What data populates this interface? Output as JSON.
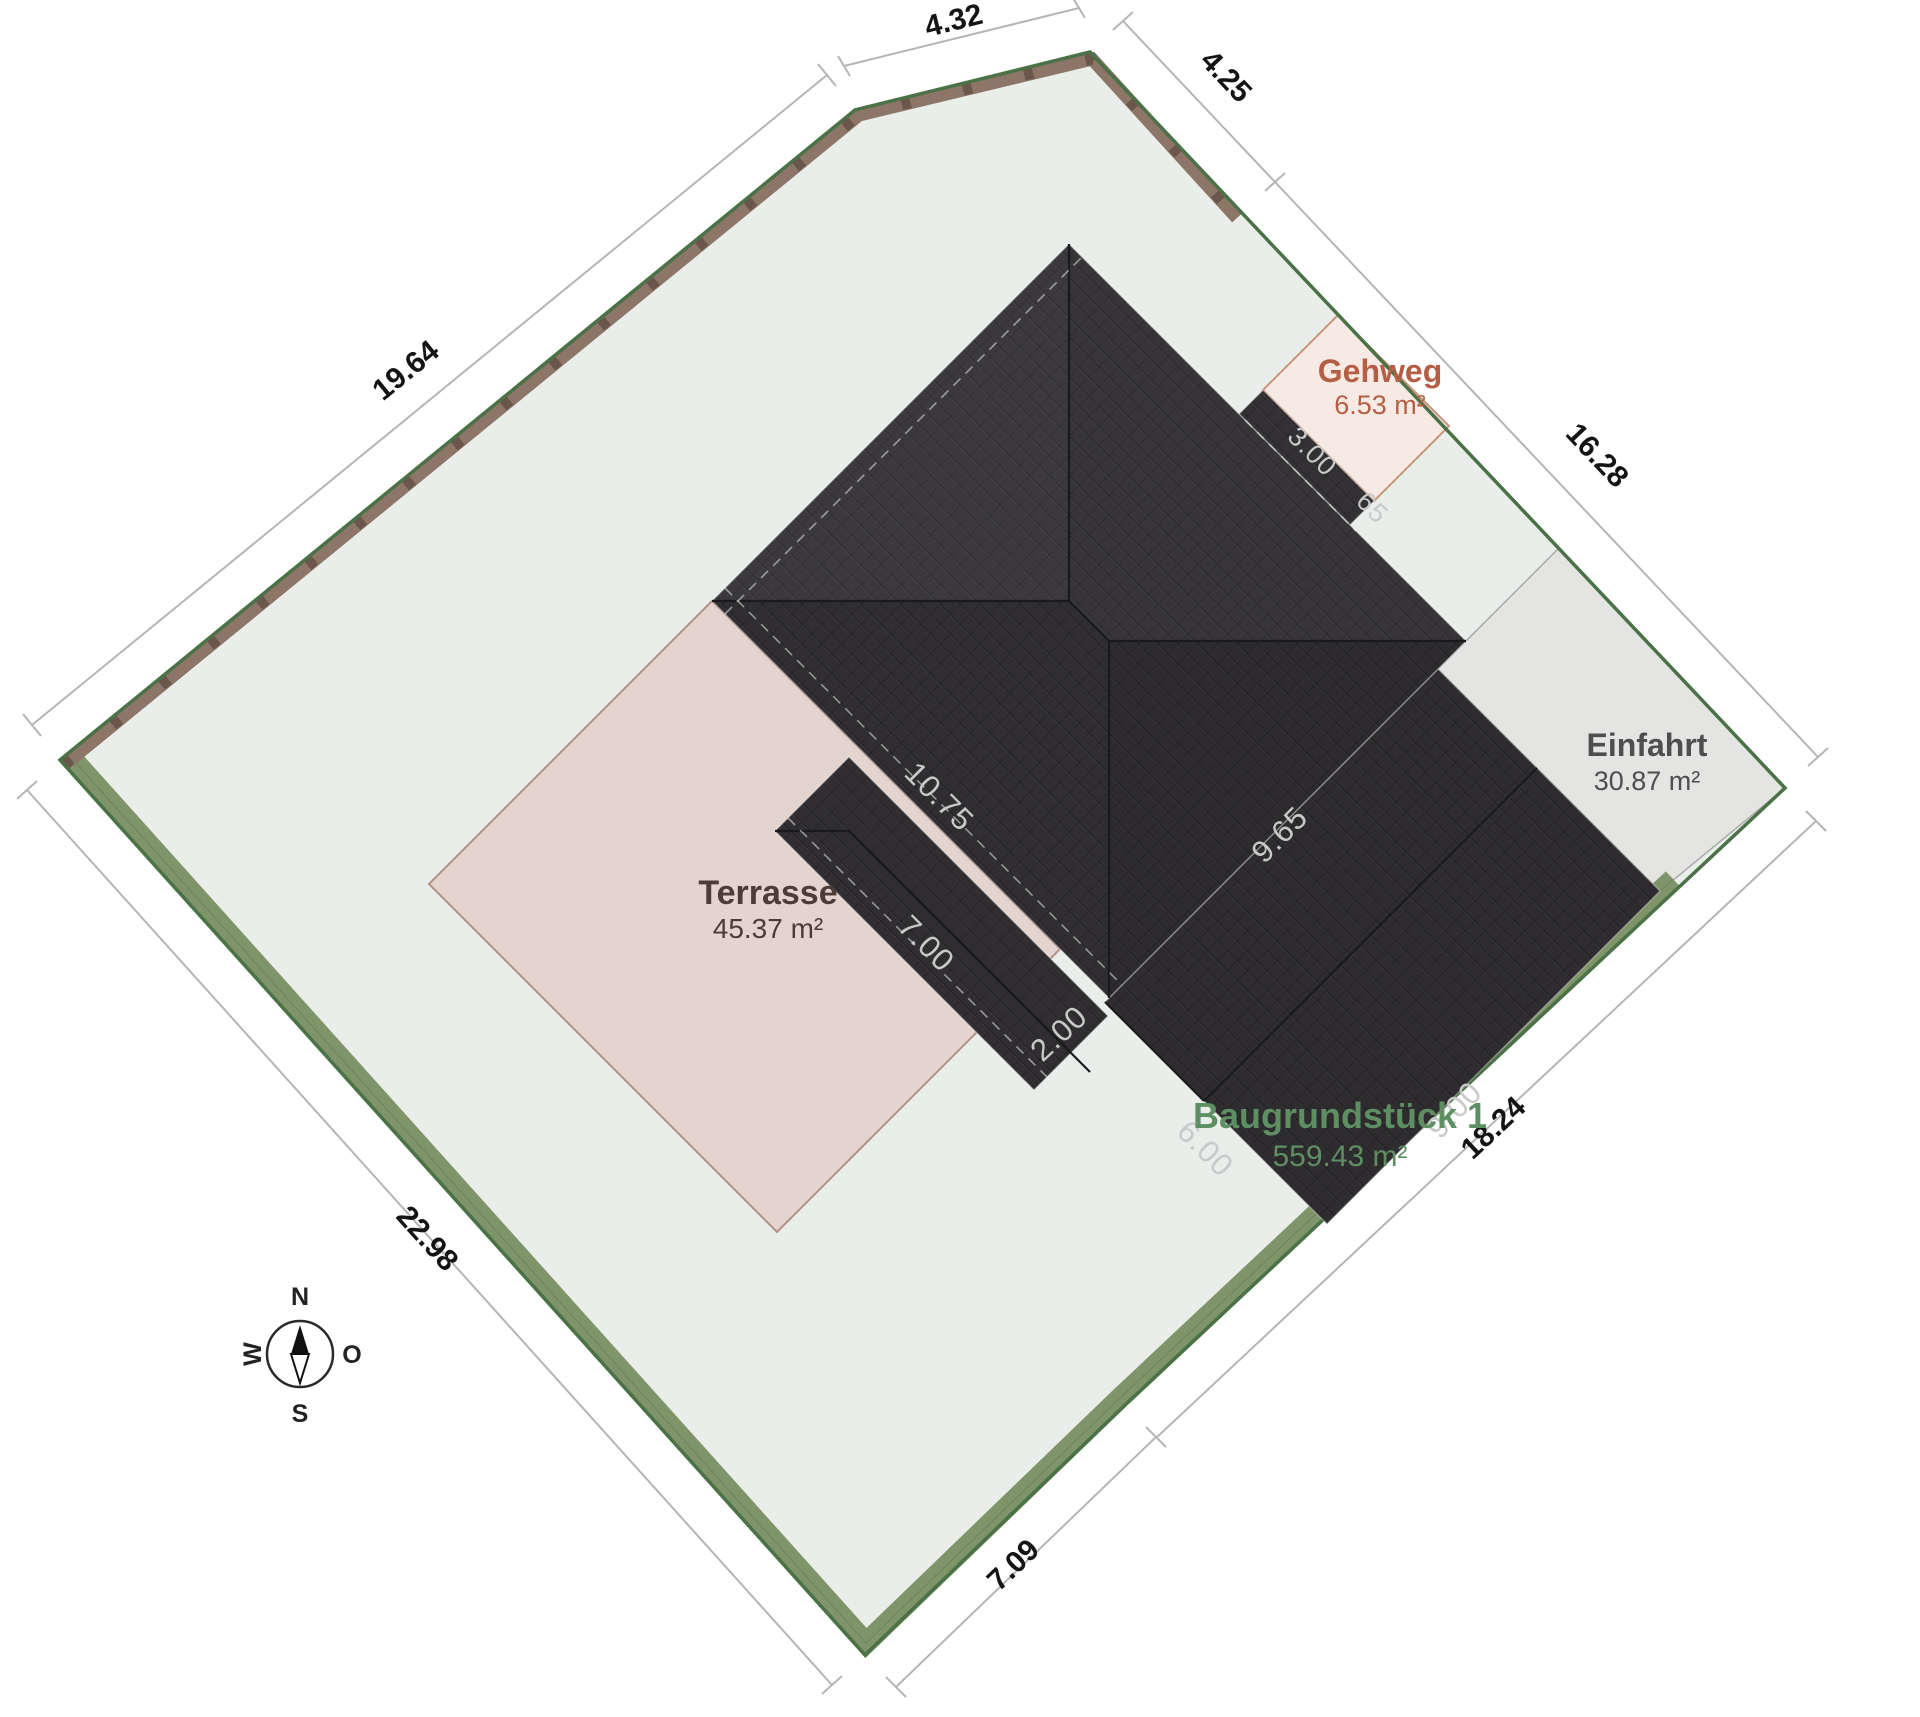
{
  "title": "Lageplan Baugrundstück",
  "boundary_dimensions": {
    "top_left": "4.32",
    "top_right": "4.25",
    "northwest": "19.64",
    "northeast": "16.28",
    "southwest": "22.98",
    "south": "7.09",
    "southeast": "18.24"
  },
  "building_dimensions": {
    "main_sw_eave": "10.75",
    "main_se_eave": "9.65",
    "wing_sw_eave": "7.00",
    "wing_se_side": "2.00",
    "garage_sw_eave": "6.00",
    "garage_se_eave": "9.00",
    "porch_length": "3.00",
    "porch_depth": "65"
  },
  "zones": {
    "gehweg": {
      "label": "Gehweg",
      "area": "6.53 m²"
    },
    "einfahrt": {
      "label": "Einfahrt",
      "area": "30.87 m²"
    },
    "terrasse": {
      "label": "Terrasse",
      "area": "45.37 m²"
    },
    "plot": {
      "label": "Baugrundstück 1",
      "area": "559.43 m²"
    }
  },
  "compass": {
    "north": "N",
    "east": "O",
    "south": "S",
    "west": "W"
  },
  "colors": {
    "plot_fill": "#e9eeea",
    "boundary_green": "#4b7247",
    "hedge": "#7f9468",
    "fence": "#8d7668",
    "fence_post": "#6a564a",
    "roof": "#333134",
    "roof_line": "#1a191b",
    "dim_text": "#141414",
    "dim_line": "#b5b5b5",
    "gehweg_fill": "#f7eae4",
    "gehweg_text": "#b45f45",
    "einfahrt_fill": "#e4e4e3",
    "einfahrt_text": "#4e4e4e",
    "terrasse_fill": "#e4d4ce",
    "terrasse_text": "#4c3c36",
    "plot_label": "#5d8f63",
    "roof_dim_text": "#c9c9c9"
  }
}
